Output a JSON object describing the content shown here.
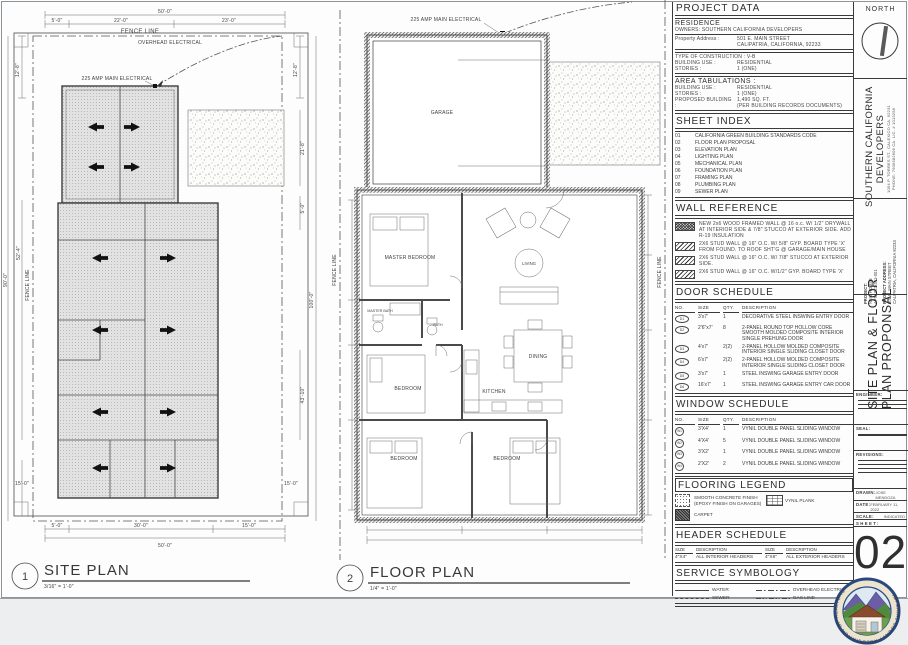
{
  "site_plan": {
    "tag_number": "1",
    "title": "SITE PLAN",
    "scale": "3/16\" = 1'-0\"",
    "fence_line_label": "FENCE LINE",
    "fence_line_label_vertical": "FENCE LINE",
    "overhead_electrical_label": "OVERHEAD ELECTRICAL",
    "main_electrical_label": "225 AMP MAIN ELECTRICAL",
    "dims": {
      "top_overall": "50'-0\"",
      "top_segments": [
        "5'-0\"",
        "22'-0\"",
        "23'-0\""
      ],
      "left_top": "12'-8\"",
      "left_mid1": "52'-4\"",
      "left_mid2": "90'-0\"",
      "left_bottom": "15'-0\"",
      "right_top": "12'-8\"",
      "right_1": "21'-8\"",
      "right_2": "5'-0\"",
      "right_3": "100'-0\"",
      "right_4": "43'-10\"",
      "right_bottom": "15'-0\"",
      "bottom_segments": [
        "5'-0\"",
        "30'-0\"",
        "15'-0\""
      ],
      "bottom_overall": "50'-0\""
    }
  },
  "floor_plan": {
    "tag_number": "2",
    "title": "FLOOR PLAN",
    "scale": "1/4\" = 1'-0\"",
    "main_electrical_label": "225 AMP MAIN ELECTRICAL",
    "fence_line_label_right": "FENCE LINE",
    "fence_line_label_left": "FENCE LINE",
    "rooms": {
      "garage": "GARAGE",
      "master_bedroom": "MASTER BEDROOM",
      "master_bath": "MASTER BATH",
      "bath": "BATH",
      "living": "LIVING",
      "dining": "DINING",
      "kitchen": "KITCHEN",
      "bedroom1": "BEDROOM",
      "bedroom2": "BEDROOM",
      "bedroom3": "BEDROOM"
    }
  },
  "title_block": {
    "project_data": {
      "heading": "PROJECT DATA",
      "residence": "RESIDENCE",
      "owners": "OWNERS: SOUTHERN CALIFORNIA DEVELOPERS",
      "property_address_label": "Property Address :",
      "property_address_1": "501 E. MAIN STREET",
      "property_address_2": "CALIPATRIA, CALIFORNIA, 92233",
      "construction_type": "TYPE OF CONSTRUCTION : V-B",
      "building_use_label": "BUILDING USE :",
      "building_use": "RESIDENTIAL",
      "stories_label": "STORIES :",
      "stories": "1 (ONE)"
    },
    "area_tabulations": {
      "heading": "AREA TABULATIONS :",
      "building_use_label": "BUILDING USE :",
      "building_use": "RESIDENTIAL",
      "stories_label": "STORIES :",
      "stories": "1 (ONE)",
      "proposed_label": "PROPOSED BUILDING :",
      "proposed_1": "1,490 SQ. FT.",
      "proposed_2": "(PER BUILDING RECORDS DOCUMENTS)"
    },
    "sheet_index": {
      "heading": "SHEET INDEX",
      "items": [
        {
          "no": "01",
          "name": "CALIFORNIA GREEN BUILDING STANDARDS CODE"
        },
        {
          "no": "02",
          "name": "FLOOR PLAN PROPOSAL"
        },
        {
          "no": "03",
          "name": "ELEVATION PLAN"
        },
        {
          "no": "04",
          "name": "LIGHTING PLAN"
        },
        {
          "no": "05",
          "name": "MECHANICAL PLAN"
        },
        {
          "no": "06",
          "name": "FOUNDATION PLAN"
        },
        {
          "no": "07",
          "name": "FRAMING PLAN"
        },
        {
          "no": "08",
          "name": "PLUMBING PLAN"
        },
        {
          "no": "09",
          "name": "SEWER PLAN"
        }
      ]
    },
    "wall_reference": {
      "heading": "WALL REFERENCE",
      "items": [
        {
          "desc": "NEW 2x6 WOOD FRAMED WALL @ 16 o.c. W/ 1/2\" DRYWALL AT INTERIOR SIDE & 7/8\" STUCCO AT EXTERIOR SIDE. ADD R-19 INSULATION"
        },
        {
          "desc": "2X6 STUD WALL @ 16\" O.C. W/ 5/8\" GYP. BOARD TYPE 'X' FROM FOUND. TO ROOF SHT'G @ GARAGE/MAIN HOUSE"
        },
        {
          "desc": "2X6 STUD WALL @ 16\" O.C. W/ 7/8\" STUCCO AT EXTERIOR SIDE."
        },
        {
          "desc": "2X6 STUD WALL @ 16\" O.C. W/1/2\" GYP. BOARD TYPE 'X'"
        }
      ]
    },
    "door_schedule": {
      "heading": "DOOR SCHEDULE",
      "columns": [
        "NO.",
        "SIZE",
        "QTY.",
        "DESCRIPTION"
      ],
      "rows": [
        {
          "tag": "D1",
          "size": "3'x7'",
          "qty": "1",
          "desc": "DECORATIVE STEEL INSWING ENTRY DOOR"
        },
        {
          "tag": "D2",
          "size": "2'6\"x7'",
          "qty": "8",
          "desc": "2-PANEL ROUND TOP HOLLOW CORE SMOOTH MOLDED COMPOSITE INTERIOR SINGLE PREHUNG DOOR"
        },
        {
          "tag": "D3",
          "size": "4'x7'",
          "qty": "2(2)",
          "desc": "2-PANEL HOLLOW MOLDED COMPOSITE INTERIOR SINGLE SLIDING CLOSET DOOR"
        },
        {
          "tag": "D4",
          "size": "6'x7'",
          "qty": "2(2)",
          "desc": "2-PANEL HOLLOW MOLDED COMPOSITE INTERIOR SINGLE SLIDING CLOSET DOOR"
        },
        {
          "tag": "D5",
          "size": "3'x7'",
          "qty": "1",
          "desc": "STEEL INSWING GARAGE ENTRY DOOR"
        },
        {
          "tag": "D6",
          "size": "16'x7'",
          "qty": "1",
          "desc": "STEEL INSWING GARAGE ENTRY CAR DOOR"
        }
      ]
    },
    "window_schedule": {
      "heading": "WINDOW SCHEDULE",
      "columns": [
        "NO.",
        "SIZE",
        "QTY.",
        "DESCRIPTION"
      ],
      "rows": [
        {
          "tag": "W1",
          "size": "3'X4'",
          "qty": "1",
          "desc": "VYNIL DOUBLE PANEL SLIDING WINDOW"
        },
        {
          "tag": "W2",
          "size": "4'X4'",
          "qty": "5",
          "desc": "VYNIL DOUBLE PANEL SLIDING WINDOW"
        },
        {
          "tag": "W3",
          "size": "3'X2'",
          "qty": "1",
          "desc": "VYNIL DOUBLE PANEL SLIDING WINDOW"
        },
        {
          "tag": "W4",
          "size": "2'X2'",
          "qty": "2",
          "desc": "VYNIL DOUBLE PANEL SLIDING WINDOW"
        }
      ]
    },
    "flooring_legend": {
      "heading": "FLOORING LEGEND",
      "concrete": "SMOOTH CONCRETE FINISH (EPOXY FINISH ON GARAGES)",
      "vinyl": "VYNIL PLANK",
      "carpet": "CARPET"
    },
    "header_schedule": {
      "heading": "HEADER SCHEDULE",
      "col_size": "SIZE",
      "col_desc": "DESCRIPTION",
      "size1": "4\"X4\"",
      "desc1": "ALL INTERIOR HEADERS",
      "size2": "4\"X6\"",
      "desc2": "ALL EXTERIOR HEADERS"
    },
    "service_symbology": {
      "heading": "SERVICE SYMBOLOGY",
      "water": "WATER",
      "sewer": "SEWER",
      "overhead": "OVERHEAD ELECTRICAL",
      "gas": "GAS LINE"
    }
  },
  "side_strip": {
    "north_label": "NORTH",
    "company_name_1": "SOUTHERN  CALIFORNIA",
    "company_name_2": "DEVELOPERS",
    "company_address": "1054 P. TORRES ST., CALEXICO CA. 92231",
    "company_phone": "PHONE: 7605582606      CA. LIC. # 1013258",
    "project_label": "PROJECT:",
    "project_name": "NEW HOUSE",
    "project_apn": "APN: 023-341-001",
    "project_address_label": "PROJECT ADDRESS:",
    "project_address_1": "501 E. MAIN STREET",
    "project_address_2": "CALIPATRIA, CALIFORNIA 92233",
    "sheet_title_1": "SITE PLAN & FLOOR",
    "sheet_title_2": "PLAN PROPONSAL",
    "engineer_label": "ENGINEER:",
    "seal_label": "SEAL:",
    "revisions_label": "REVISIONS:",
    "drawn_label": "DRAWN:",
    "drawn_value": "JOSE MENDOZA",
    "date_label": "DATE:",
    "date_value": "FEBRUARY 11, 2022",
    "scale_label": "SCALE:",
    "scale_value": "INDICATED",
    "sheet_label": "SHEET:",
    "sheet_number": "02"
  },
  "logo": {
    "ring_text": "IMPERIAL COUNTY ASSOCIATION OF REALTORS"
  }
}
